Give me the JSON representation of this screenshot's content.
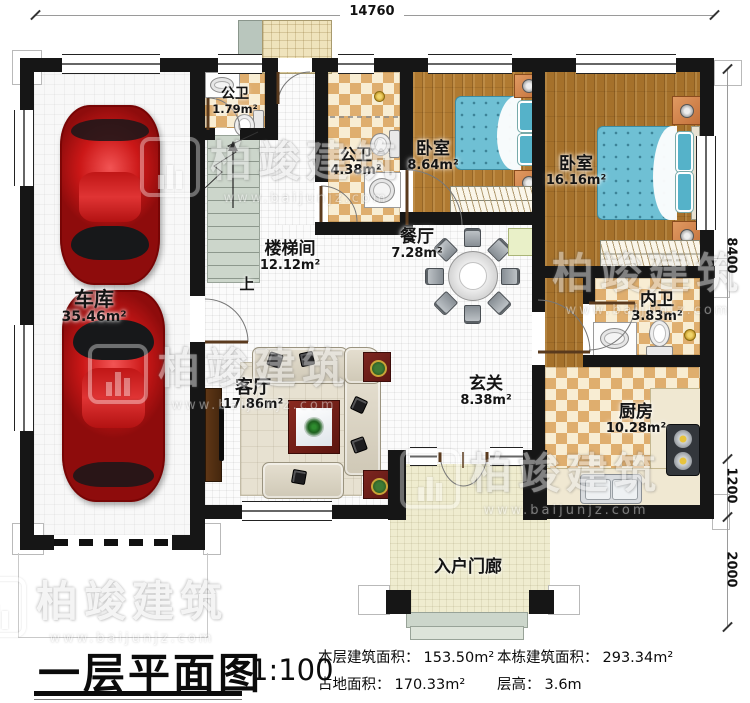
{
  "plan": {
    "title": "一层平面图",
    "scale": "1:100",
    "stats": [
      {
        "label": "本层建筑面积：",
        "value": "153.50m²"
      },
      {
        "label": "占地面积：",
        "value": "170.33m²"
      },
      {
        "label": "本栋建筑面积：",
        "value": "293.34m²"
      },
      {
        "label": "层高：",
        "value": "3.6m"
      }
    ]
  },
  "dimensions": {
    "top": "14760",
    "right_top": "8400",
    "right_mid": "1200",
    "right_bottom": "2000"
  },
  "rooms": {
    "garage": {
      "name": "车库",
      "area": "35.46m²"
    },
    "bath1": {
      "name": "公卫",
      "area": "1.79m²"
    },
    "bath2": {
      "name": "公卫",
      "area": "4.38m²"
    },
    "bedroom1": {
      "name": "卧室",
      "area": "8.64m²"
    },
    "bedroom2": {
      "name": "卧室",
      "area": "16.16m²"
    },
    "stairwell": {
      "name": "楼梯间",
      "area": "12.12m²"
    },
    "dining": {
      "name": "餐厅",
      "area": "7.28m²"
    },
    "ensuite": {
      "name": "内卫",
      "area": "3.83m²"
    },
    "kitchen": {
      "name": "厨房",
      "area": "10.28m²"
    },
    "living": {
      "name": "客厅",
      "area": "17.86m²"
    },
    "foyer": {
      "name": "玄关",
      "area": "8.38m²"
    },
    "porch": {
      "name": "入户门廊"
    }
  },
  "stairs": {
    "direction_label": "上"
  },
  "watermark": {
    "brand": "柏竣建筑",
    "url": "www.baijunjz.com"
  },
  "colors": {
    "wall": "#161616",
    "wood": "#b07a31",
    "tile": "#dfae6e",
    "bed": "#6fc0d4",
    "car": "#cb1717"
  }
}
